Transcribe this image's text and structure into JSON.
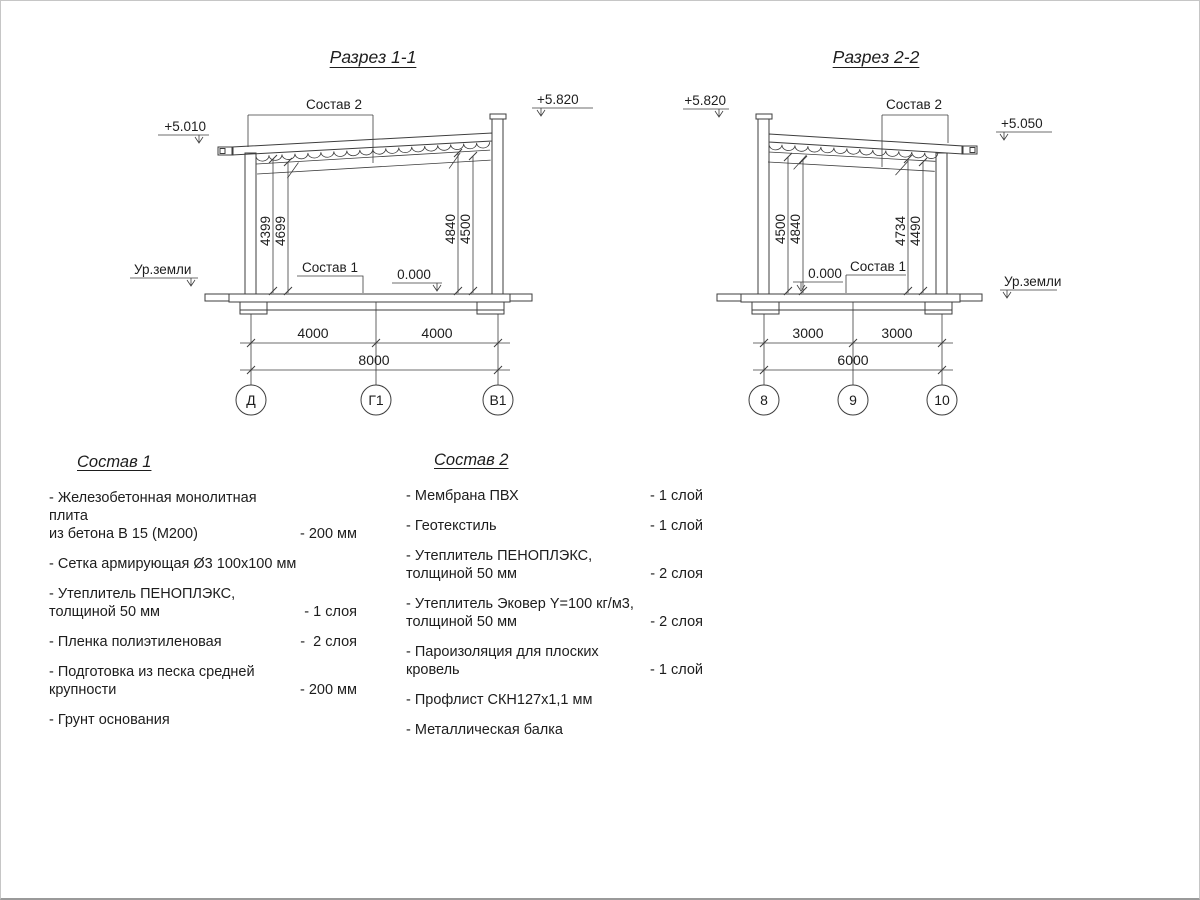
{
  "sections": {
    "s1": {
      "title": "Разрез 1-1",
      "elev_left": "+5.010",
      "elev_right": "+5.820",
      "roof_callout": "Состав 2",
      "floor_callout": "Состав 1",
      "zero_mark": "0.000",
      "ground": "Ур.земли",
      "h1": "4399",
      "h2": "4699",
      "h3": "4840",
      "h4": "4500",
      "span1": "4000",
      "span2": "4000",
      "total": "8000",
      "axis1": "Д",
      "axis2": "Г1",
      "axis3": "В1"
    },
    "s2": {
      "title": "Разрез 2-2",
      "elev_left": "+5.820",
      "elev_right": "+5.050",
      "roof_callout": "Состав 2",
      "floor_callout": "Состав 1",
      "zero_mark": "0.000",
      "ground": "Ур.земли",
      "h1": "4500",
      "h2": "4840",
      "h3": "4734",
      "h4": "4490",
      "span1": "3000",
      "span2": "3000",
      "total": "6000",
      "axis1": "8",
      "axis2": "9",
      "axis3": "10"
    }
  },
  "comp1": {
    "title": "Состав 1",
    "items": [
      {
        "text": "- Железобетонная  монолитная плита\nиз бетона В 15 (М200)",
        "value": "- 200 мм"
      },
      {
        "text": "- Сетка армирующая Ø3 100х100 мм",
        "value": ""
      },
      {
        "text": "-  Утеплитель ПЕНОПЛЭКС,\n толщиной 50 мм",
        "value": "- 1 слоя"
      },
      {
        "text": "- Пленка полиэтиленовая",
        "value": "-  2 слоя"
      },
      {
        "text": "- Подготовка из песка средней\n  крупности",
        "value": "- 200 мм"
      },
      {
        "text": "- Грунт основания",
        "value": ""
      }
    ]
  },
  "comp2": {
    "title": "Состав 2",
    "items": [
      {
        "text": "- Мембрана ПВХ",
        "value": "- 1 слой"
      },
      {
        "text": "- Геотекстиль",
        "value": "- 1 слой"
      },
      {
        "text": "- Утеплитель ПЕНОПЛЭКС,\n  толщиной 50 мм",
        "value": "- 2 слоя"
      },
      {
        "text": "- Утеплитель Эковер Y=100 кг/м3,\n  толщиной 50 мм",
        "value": "- 2 слоя"
      },
      {
        "text": "- Пароизоляция для плоских кровель",
        "value": "- 1 слой"
      },
      {
        "text": "- Профлист СКН127х1,1 мм",
        "value": ""
      },
      {
        "text": "- Металлическая балка",
        "value": ""
      }
    ]
  }
}
